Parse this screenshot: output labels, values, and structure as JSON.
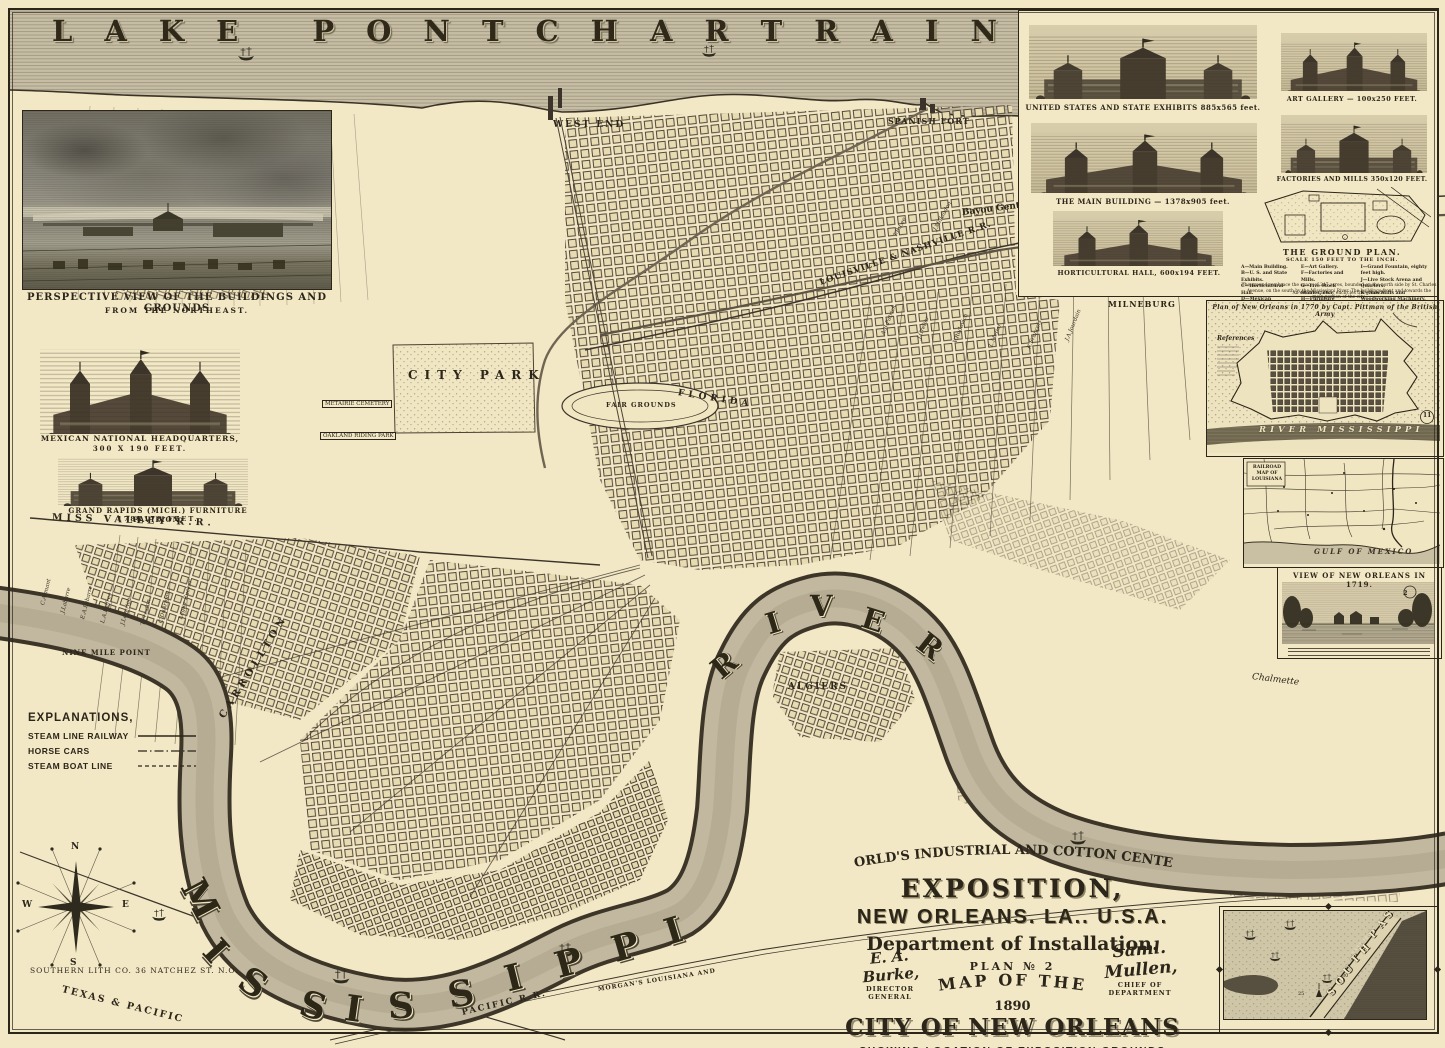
{
  "paper_color": "#f2e8c6",
  "ink_color": "#2c2519",
  "water_color": "#bdb49c",
  "lake": {
    "label": "LAKE PONTCHARTRAIN"
  },
  "river": {
    "word_mississippi": "MISSISSIPPI",
    "word_river": "RIVER"
  },
  "compass": {
    "n": "N",
    "e": "E",
    "s": "S",
    "w": "W"
  },
  "imprint": "SOUTHERN LITH CO. 36 NATCHEZ ST. N.O.",
  "labels": {
    "west_end": "WEST END",
    "spanish_fort": "SPANISH FORT",
    "milneburg": "MILNEBURG",
    "city_park": "CITY PARK",
    "fair_grounds": "FAIR GROUNDS",
    "carrollton": "CARROLLTON",
    "algiers": "ALGIERS",
    "metairie_cemetery": "METAIRIE CEMETERY",
    "oakland_riding_park": "OAKLAND RIDING PARK",
    "nine_mile_point": "NINE MILE POINT",
    "florida_ave": "FLORIDA",
    "chalmette": "Chalmette",
    "bayou_gentilly": "Bayou Gentilly",
    "louisville_nashville_rr": "LOUISVILLE & NASHVILLE R.R.",
    "miss_valley_rr": "MISS VALLEY R.R.",
    "texas_pacific": "TEXAS & PACIFIC",
    "pacific_rr": "PACIFIC R.R.",
    "morgans_louisiana": "MORGAN'S LOUISIANA AND"
  },
  "property_names": {
    "gentilly": [
      "A.B.Patrick",
      "J.Grelier",
      "V.Rudovich",
      "L.Metier",
      "R.Francois",
      "J.A.Jourdain",
      "T.B.Lee",
      "J.Millaudon"
    ],
    "uptown": [
      "C.Armant",
      "J.Labarre",
      "E.A.Labarre",
      "L.A.Palfrey",
      "J.Leverich",
      "T.Preston",
      "C.DuArmas",
      "Legier Rucker"
    ]
  },
  "legend": {
    "heading": "EXPLANATIONS,",
    "items": [
      {
        "label": "STEAM LINE RAILWAY",
        "style": "solid"
      },
      {
        "label": "HORSE CARS",
        "style": "dash-dot"
      },
      {
        "label": "STEAM BOAT LINE",
        "style": "dashed"
      }
    ]
  },
  "insets": {
    "perspective": {
      "caption_line1": "PERSPECTIVE VIEW OF THE BUILDINGS AND GROUNDS",
      "caption_line2": "FROM THE NORTHEAST."
    },
    "mexican_hq": {
      "caption_line1": "MEXICAN NATIONAL HEADQUARTERS,",
      "caption_line2": "300 X 190 FEET."
    },
    "grand_rapids": {
      "caption_line1": "GRAND RAPIDS (MICH.) FURNITURE PAVILION,",
      "caption_line2": "178X178 FEET."
    },
    "exhibit_panel": {
      "engravings": [
        {
          "caption": "UNITED STATES AND STATE EXHIBITS  885x565 feet."
        },
        {
          "caption": "ART GALLERY — 100x250 FEET."
        },
        {
          "caption": "THE MAIN BUILDING — 1378x905 feet."
        },
        {
          "caption": "FACTORIES AND MILLS  350x120 FEET."
        },
        {
          "caption": "HORTICULTURAL HALL, 600x194 FEET."
        }
      ],
      "ground_plan": {
        "title": "THE GROUND PLAN.",
        "scale": "SCALE 150 FEET TO THE INCH.",
        "key_col1": [
          "A—Main Building.",
          "B—U. S. and State Exhibits.",
          "C—Horticultural Hall.",
          "D—Mexican Buildings."
        ],
        "key_col2": [
          "E—Art Gallery.",
          "F—Factories and Mills.",
          "G—Live Stock Stables, etc.",
          "H—Furniture Pavilion."
        ],
        "key_col3": [
          "I—Grand Fountain, eighty feet high.",
          "J—Live Stock Arena and Quarters.",
          "K—Saw Mills and Woodworking Machinery.",
          "L—Wharf, Mississippi River."
        ],
        "note1": "The grounds embrace the space of 247 acres, bounded on the north side by St. Charles Avenue, on the south by the Mississippi River.  The buildings front and towards the main portion of the city.",
        "note2": "An electric railway encircles the grounds."
      }
    },
    "plan_1770": {
      "title": "Plan of New Orleans in 1770 by Capt. Pittman of the British Army",
      "references": "References",
      "river_label": "RIVER MISSISSIPPI",
      "badge": "11"
    },
    "railroad_map": {
      "title": "RAILROAD MAP OF LOUISIANA",
      "gulf_label": "GULF OF MEXICO"
    },
    "view_1719": {
      "title": "VIEW OF NEW ORLEANS IN 1719.",
      "badge": "2"
    },
    "south_pass": {
      "label": "SOUTH PASS",
      "jetty_label": "EAST JETTY",
      "depth_a": "30",
      "depth_b": "25"
    }
  },
  "title_block": {
    "arch_line": "THE WORLD'S INDUSTRIAL AND COTTON CENTENNIAL",
    "exposition": "EXPOSITION,",
    "city_line": "NEW ORLEANS. LA.. U.S.A.",
    "department": "Department of Installation.",
    "plan_no": "PLAN № 2",
    "map_of_the": "MAP OF THE",
    "year": "1890",
    "city_of": "CITY OF NEW ORLEANS",
    "showing": "SHOWING LOCATION OF EXPOSITION GROUNDS",
    "approaches": "AND ALL APPROACHES THERETO BY LAND & WATER",
    "sig_left_name": "E. A. Burke,",
    "sig_left_title": "DIRECTOR GENERAL",
    "sig_right_name": "Saml. Mullen,",
    "sig_right_title": "CHIEF OF DEPARTMENT"
  }
}
